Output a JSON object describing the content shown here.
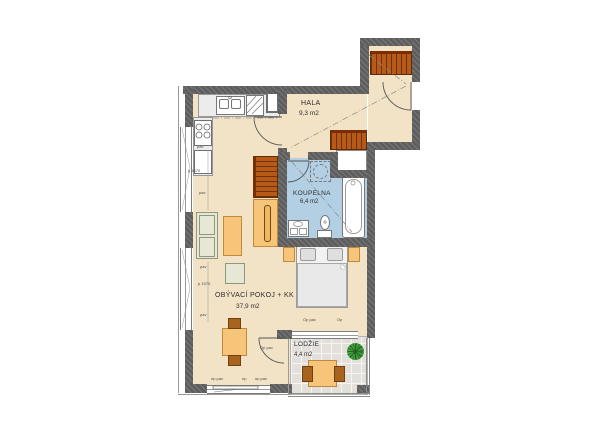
{
  "plan_title": "apartment floor plan",
  "rooms": {
    "hala": {
      "name": "HALA",
      "area": "9,3 m2"
    },
    "koupelna": {
      "name": "KOUPELNA",
      "area": "6,4 m2"
    },
    "obyvaci": {
      "name": "OBÝVACÍ POKOJ + KK",
      "area": "37,9 m2"
    },
    "lodzie": {
      "name": "LODŽIE",
      "area": "4,4 m2"
    }
  },
  "annotations": {
    "p1570_top": "p 1570",
    "p1570_bottom": "p 1570",
    "pav_kitchen": "pav",
    "pav_w1": "pav",
    "pav_w2a": "pav",
    "pav_w2b": "pav",
    "np_pav_left": "np pav",
    "np_mid": "np",
    "np_pav_right": "np pav",
    "op_pav_top": "Op pav",
    "op_top": "Op",
    "op_pav_side": "Op pav"
  },
  "colors": {
    "wall": "#5e5e5e",
    "floor": "#f2e3c6",
    "bathroom_floor": "#b2cfe3",
    "loggia_tile": "#e3dfda",
    "furniture_orange": "#f7c579",
    "furniture_brown": "#a8641f",
    "wardrobe_rust": "#b85a17",
    "sofa_sage": "#e6e8d5",
    "plant_green": "#3c8f39"
  }
}
